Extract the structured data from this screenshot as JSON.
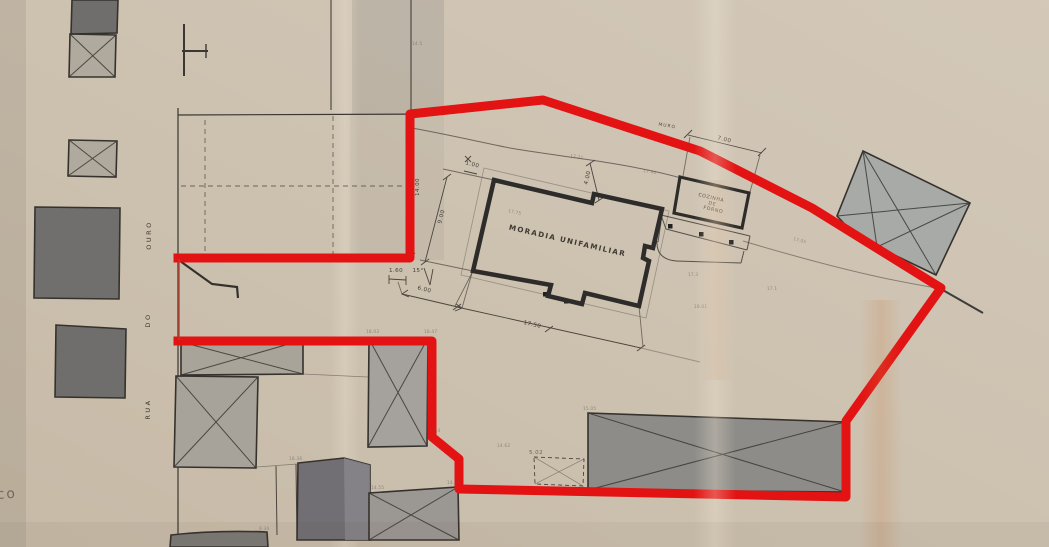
{
  "labels": {
    "main_building": "MORADIA UNIFAMILIAR",
    "kitchen_l1": "COZINHA",
    "kitchen_l2": "DE",
    "kitchen_l3": "FORNO",
    "wall": "MURO",
    "street_w1": "RUA",
    "street_w2": "DO",
    "street_w3": "OURO",
    "edge_fragment": "co"
  },
  "dims": {
    "plot_depth": "14.00",
    "house_width": "9.00",
    "offset_small": "1.00",
    "gap_top": "4.00",
    "top_right": "7.00",
    "front_left": "1.60",
    "angle": "15°",
    "front_gap": "6.00",
    "house_length": "17.50",
    "shed": "5.02"
  },
  "spots": [
    {
      "v": "17.21"
    },
    {
      "v": "17.40"
    },
    {
      "v": "17.75"
    },
    {
      "v": "17.3"
    },
    {
      "v": "18.01"
    },
    {
      "v": "17.05"
    },
    {
      "v": "17.1"
    },
    {
      "v": "15.05"
    },
    {
      "v": "14.55"
    },
    {
      "v": "14.05"
    },
    {
      "v": "14.4"
    },
    {
      "v": "18.03"
    },
    {
      "v": "18.47"
    },
    {
      "v": "14.62"
    },
    {
      "v": "18.36"
    },
    {
      "v": "9.34"
    },
    {
      "v": "14.5"
    }
  ],
  "colors": {
    "boundary": "#e31313",
    "boundary_thin": "#c03a2a",
    "paper": "#c7baa7",
    "building_dark": "#6f6e6c",
    "building_light": "#a9a49a",
    "ink": "#2e2c2a"
  }
}
